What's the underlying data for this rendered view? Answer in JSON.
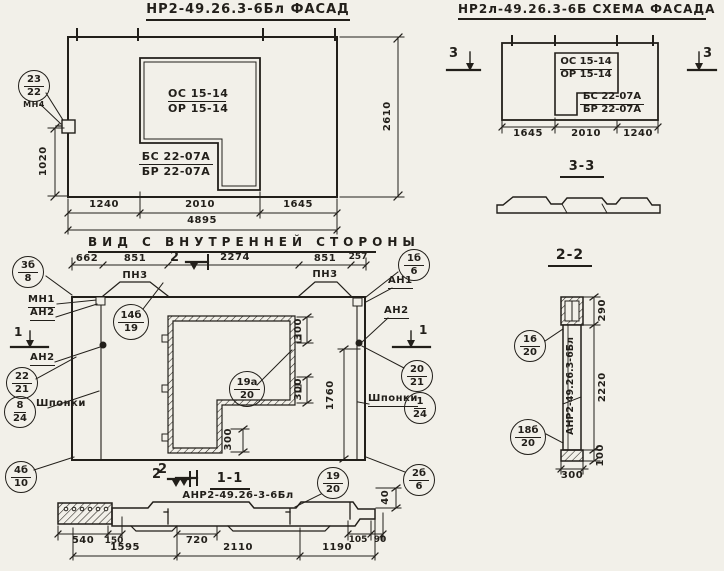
{
  "colors": {
    "paper": "#f2f0e9",
    "ink": "#221f1a"
  },
  "facade": {
    "title": "НР2-49.26.3-6Бл  ФАСАД",
    "win_top1": "ОС 15-14",
    "win_top2": "ОР 15-14",
    "win_bot1": "БС 22-07А",
    "win_bot2": "БР 22-07А",
    "callout": {
      "num": "23",
      "den": "22"
    },
    "callout_label": "МН4",
    "dim_left": "1020",
    "dim_right": "2610",
    "dim_b1": "1240",
    "dim_b2": "2010",
    "dim_b3": "1645",
    "dim_total": "4895"
  },
  "schema": {
    "title": "НР2л-49.26.3-6Б  СХЕМА ФАСАДА",
    "win_top1": "ОС 15-14",
    "win_top2": "ОР 15-14",
    "win_bot1": "БС 22-07А",
    "win_bot2": "БР 22-07А",
    "dim_b1": "1645",
    "dim_b2": "2010",
    "dim_b3": "1240",
    "mark_left": "3",
    "mark_right": "3",
    "section_title": "3-3"
  },
  "inner": {
    "title": "ВИД С ВНУТРЕННЕЙ СТОРОНЫ",
    "dim_t1": "662",
    "dim_t2": "851",
    "dim_t3": "2274",
    "dim_t4": "851",
    "dim_t5": "257",
    "mark2_top": "2",
    "mark2_bottom": "2",
    "mark1_left": "1",
    "mark1_right": "1",
    "pn3_left": "ПН3",
    "pn3_right": "ПН3",
    "mn1": "МН1",
    "an2_l1": "АН2",
    "an2_l2": "АН2",
    "an1": "АН1",
    "an2_r": "АН2",
    "shponki_left": "Шпонки",
    "shponki_right": "Шпонки",
    "dim_300_a": "300",
    "dim_300_b": "300",
    "dim_300_c": "300",
    "dim_1760": "1760",
    "callouts": {
      "c3b": {
        "num": "3б",
        "den": "8"
      },
      "c14b": {
        "num": "14б",
        "den": "19"
      },
      "c1b": {
        "num": "1б",
        "den": "6"
      },
      "c22": {
        "num": "22",
        "den": "21"
      },
      "c8": {
        "num": "8",
        "den": "24"
      },
      "c4b": {
        "num": "4б",
        "den": "10"
      },
      "c19a": {
        "num": "19а",
        "den": "20"
      },
      "c20": {
        "num": "20",
        "den": "21"
      },
      "c1": {
        "num": "1",
        "den": "24"
      },
      "c2b": {
        "num": "2б",
        "den": "6"
      }
    }
  },
  "section11": {
    "mark": "2",
    "title": "1-1",
    "label": "АНР2-49.26-3-6Бл",
    "callout": {
      "num": "19",
      "den": "20"
    },
    "d540": "540",
    "d150": "150",
    "d720": "720",
    "d105": "105",
    "d90": "90",
    "d1595": "1595",
    "d2110": "2110",
    "d1190": "1190",
    "d40": "40"
  },
  "section22": {
    "title": "2-2",
    "label": "АНР2-49.26.3-6Бл",
    "c16": {
      "num": "16",
      "den": "20"
    },
    "c18b": {
      "num": "18б",
      "den": "20"
    },
    "d290": "290",
    "d2220": "2220",
    "d100": "100",
    "d300": "300"
  }
}
